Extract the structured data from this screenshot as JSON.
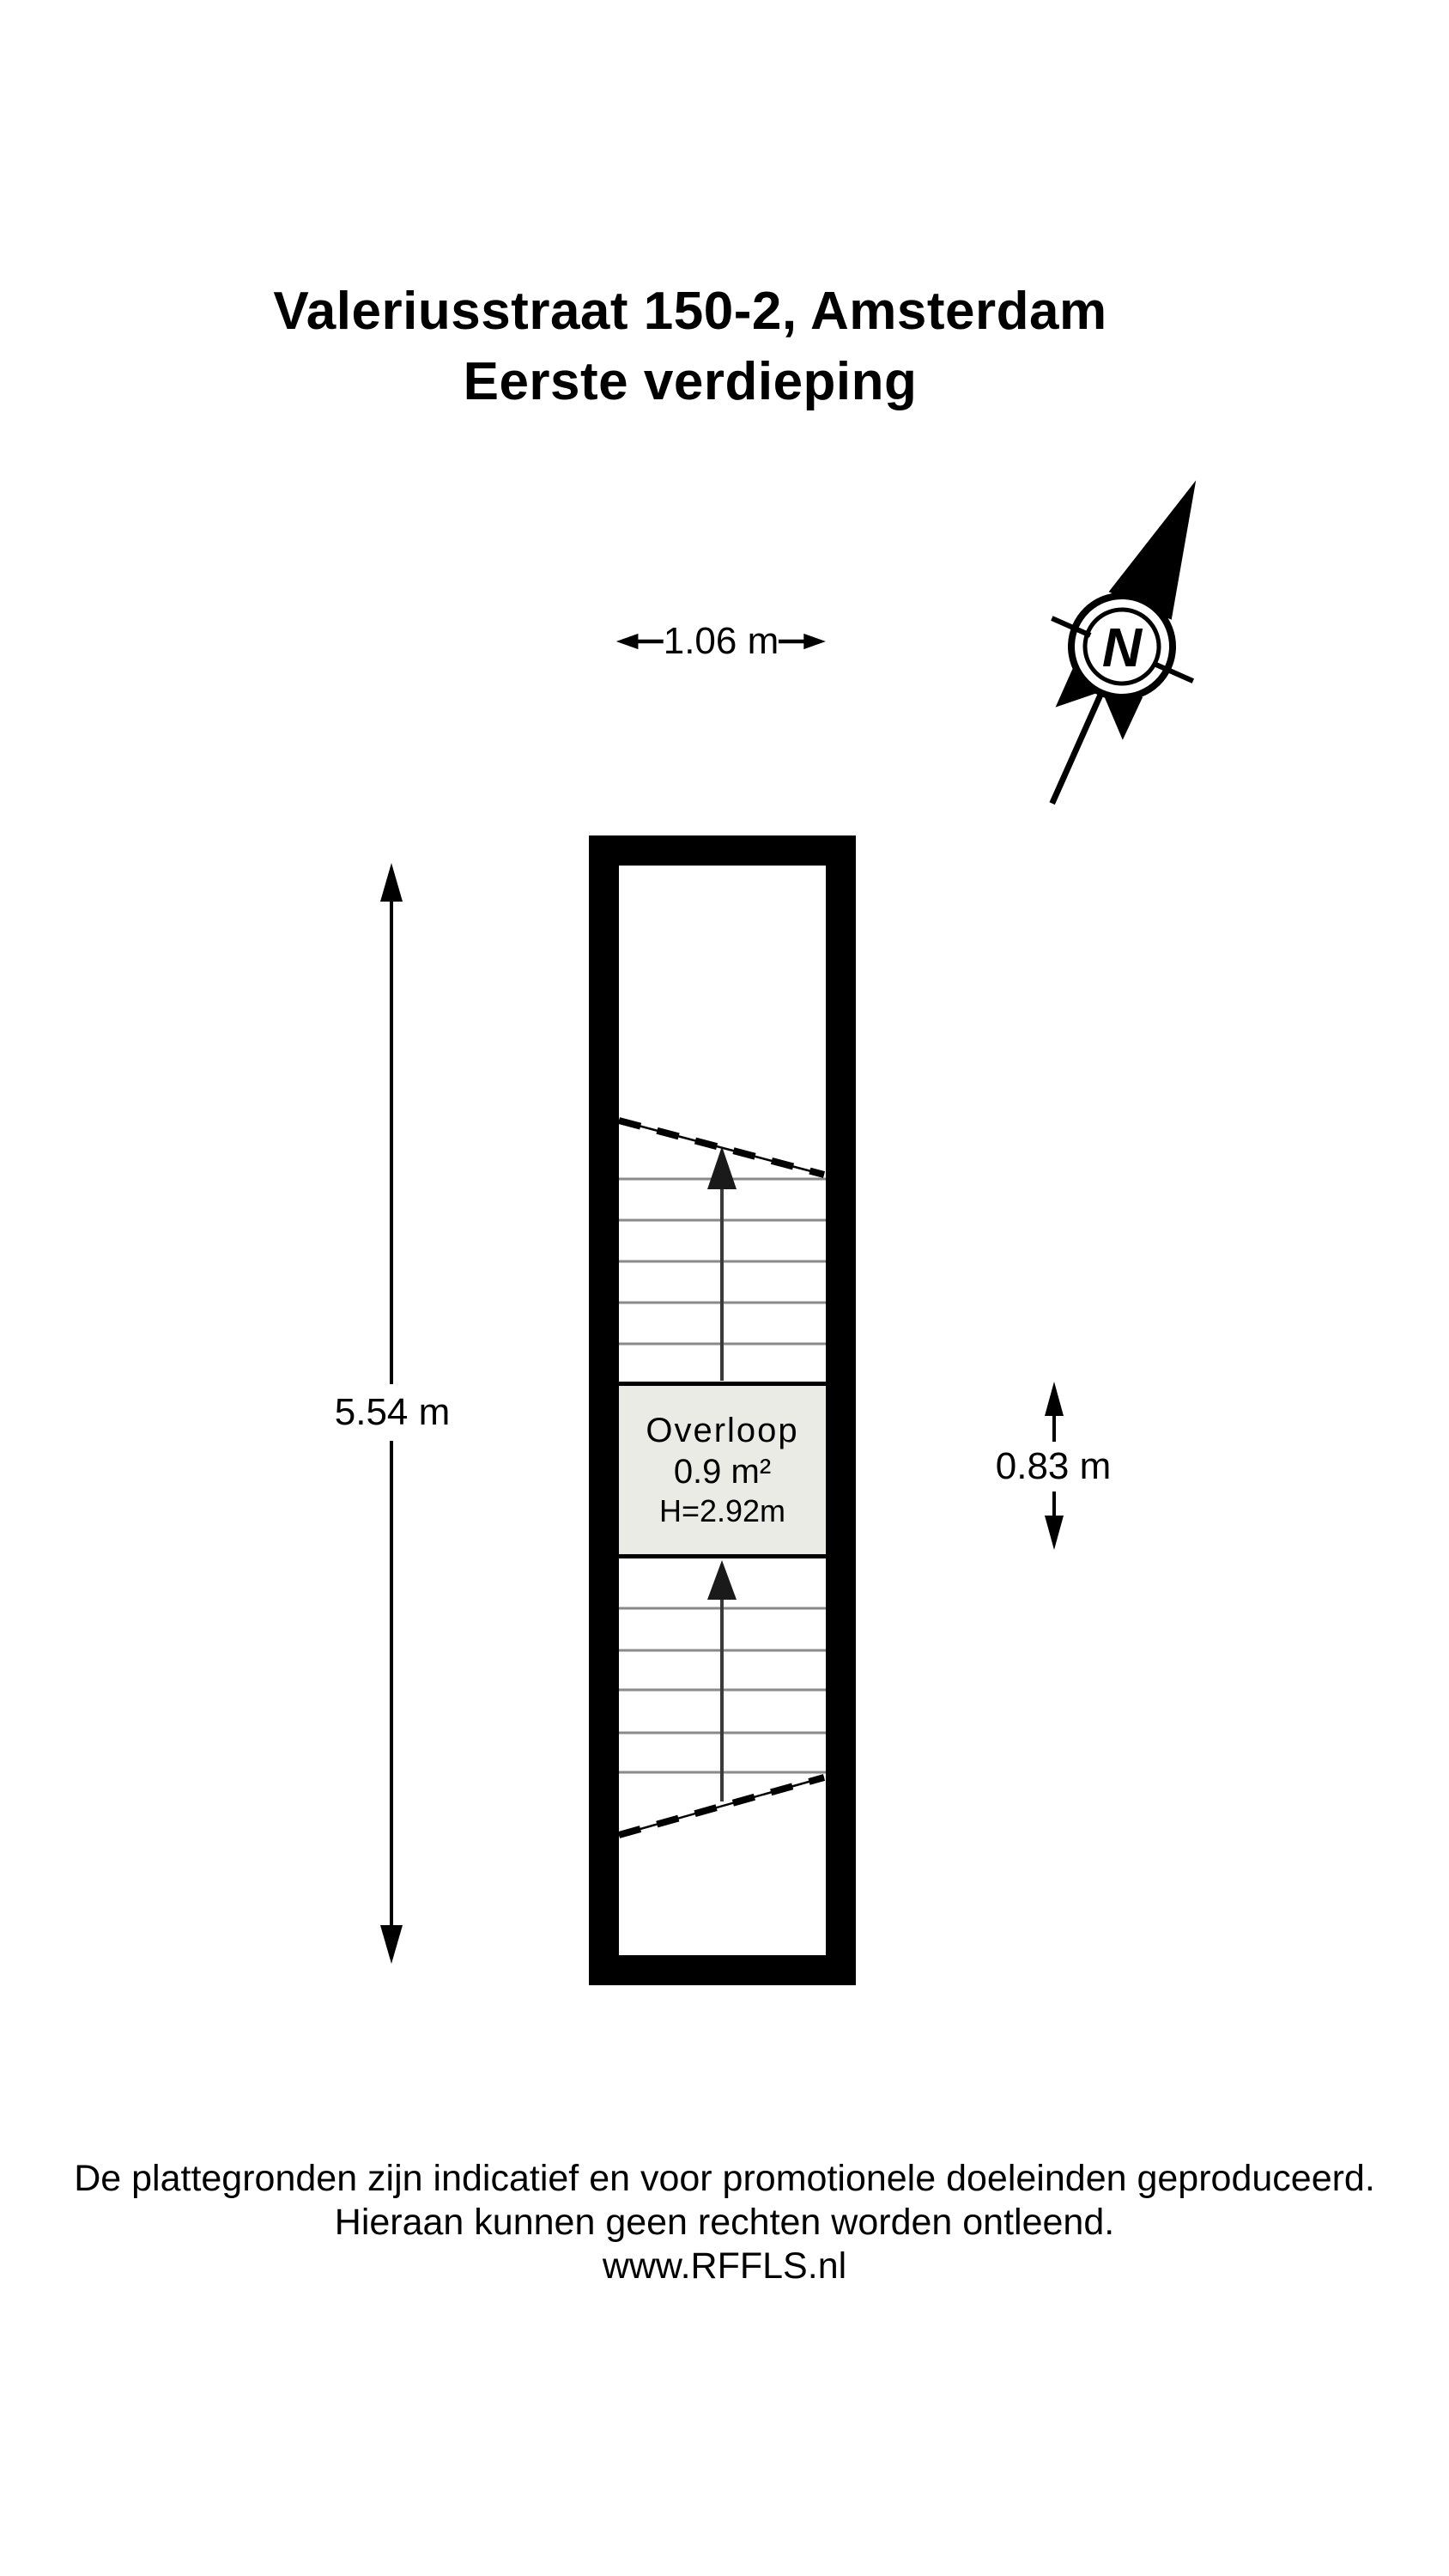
{
  "title": {
    "line1": "Valeriusstraat 150-2, Amsterdam",
    "line2": "Eerste verdieping"
  },
  "compass": {
    "north_label": "N"
  },
  "dimensions": {
    "plan_width": "1.06 m",
    "plan_height": "5.54 m",
    "landing_height": "0.83 m"
  },
  "rooms": [
    {
      "name": "Overloop",
      "area": "0.9 m²",
      "ceiling_height": "H=2.92m"
    }
  ],
  "footer": {
    "line1": "De plattegronden zijn indicatief en voor promotionele doeleinden geproduceerd.",
    "line2": "Hieraan kunnen geen rechten worden ontleend.",
    "line3": "www.RFFLS.nl"
  },
  "colors": {
    "ink": "#000000",
    "room_fill": "#ebebe6",
    "stair_tread": "#8a8a8a"
  }
}
